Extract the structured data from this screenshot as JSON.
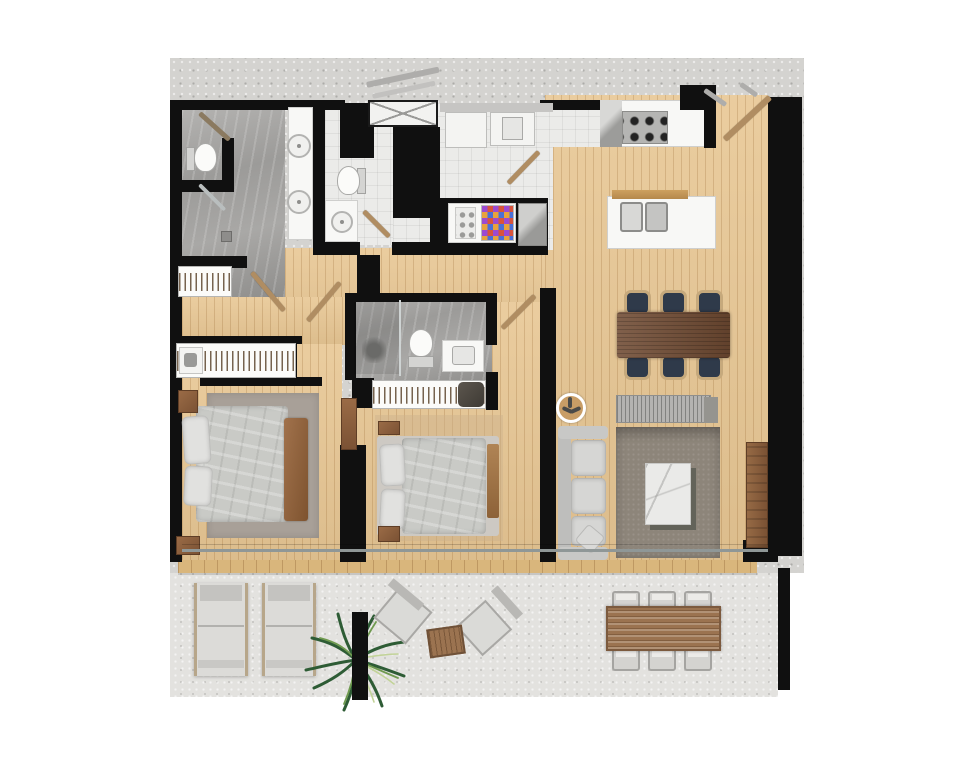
{
  "scene": {
    "type": "architectural-floor-plan",
    "description": "top-down rendered apartment floor plan with terrace",
    "rooms": [
      {
        "name": "main-bathroom",
        "features": [
          "toilet",
          "double-vanity",
          "walk-in-shower"
        ]
      },
      {
        "name": "guest-bathroom",
        "features": [
          "toilet",
          "vanity-sink"
        ]
      },
      {
        "name": "laundry",
        "features": [
          "washer",
          "dryer",
          "pantry-shelves"
        ]
      },
      {
        "name": "kitchen",
        "features": [
          "5-burner-stove",
          "island-double-sink",
          "breakfast-bar"
        ]
      },
      {
        "name": "dining-area",
        "features": [
          "table-for-six"
        ]
      },
      {
        "name": "living-room",
        "features": [
          "sofa",
          "coffee-table",
          "rug",
          "sideboard",
          "tv-console",
          "ceiling-fan"
        ]
      },
      {
        "name": "master-bedroom",
        "features": [
          "double-bed",
          "wardrobe",
          "nightstands",
          "rug"
        ]
      },
      {
        "name": "second-bedroom",
        "features": [
          "double-bed",
          "wardrobe",
          "ensuite-bathroom"
        ]
      },
      {
        "name": "hallway",
        "features": [
          "closet",
          "service-shaft"
        ]
      },
      {
        "name": "terrace",
        "features": [
          "sun-loungers",
          "palm-plant",
          "lounge-chairs",
          "outdoor-dining-table",
          "structural-column"
        ]
      }
    ]
  },
  "palette": {
    "wall": "#101010",
    "wood": "#e8c794",
    "deck": "#d9b67c",
    "concrete": "#d4d3d0",
    "terrace": "#e3e2df",
    "lighttile": "#ebebe9",
    "counter": "#f8f8f6",
    "stainless": "#b5b5b3",
    "sofa": "#d6d6d4",
    "rugliving": "#8d857a",
    "rugbed": "#a8a098",
    "duvet": "#c9cac6",
    "pillow": "#e1e1df",
    "furnwood": "#8a5f3f",
    "diningtable": "#6f4a32",
    "rattan": "#c6a97c",
    "navy": "#2f3a4a",
    "marble": "#eaeae8",
    "sideboard": "#b4b3b1",
    "plantdark": "#2e5c35",
    "plantlight": "#6f9a4f",
    "planthighlight": "#c2d398",
    "lounger": "#dcdbd8",
    "outtable": "#9b7350",
    "doorleaf": "#b08d62",
    "glass": "#8f9797"
  }
}
